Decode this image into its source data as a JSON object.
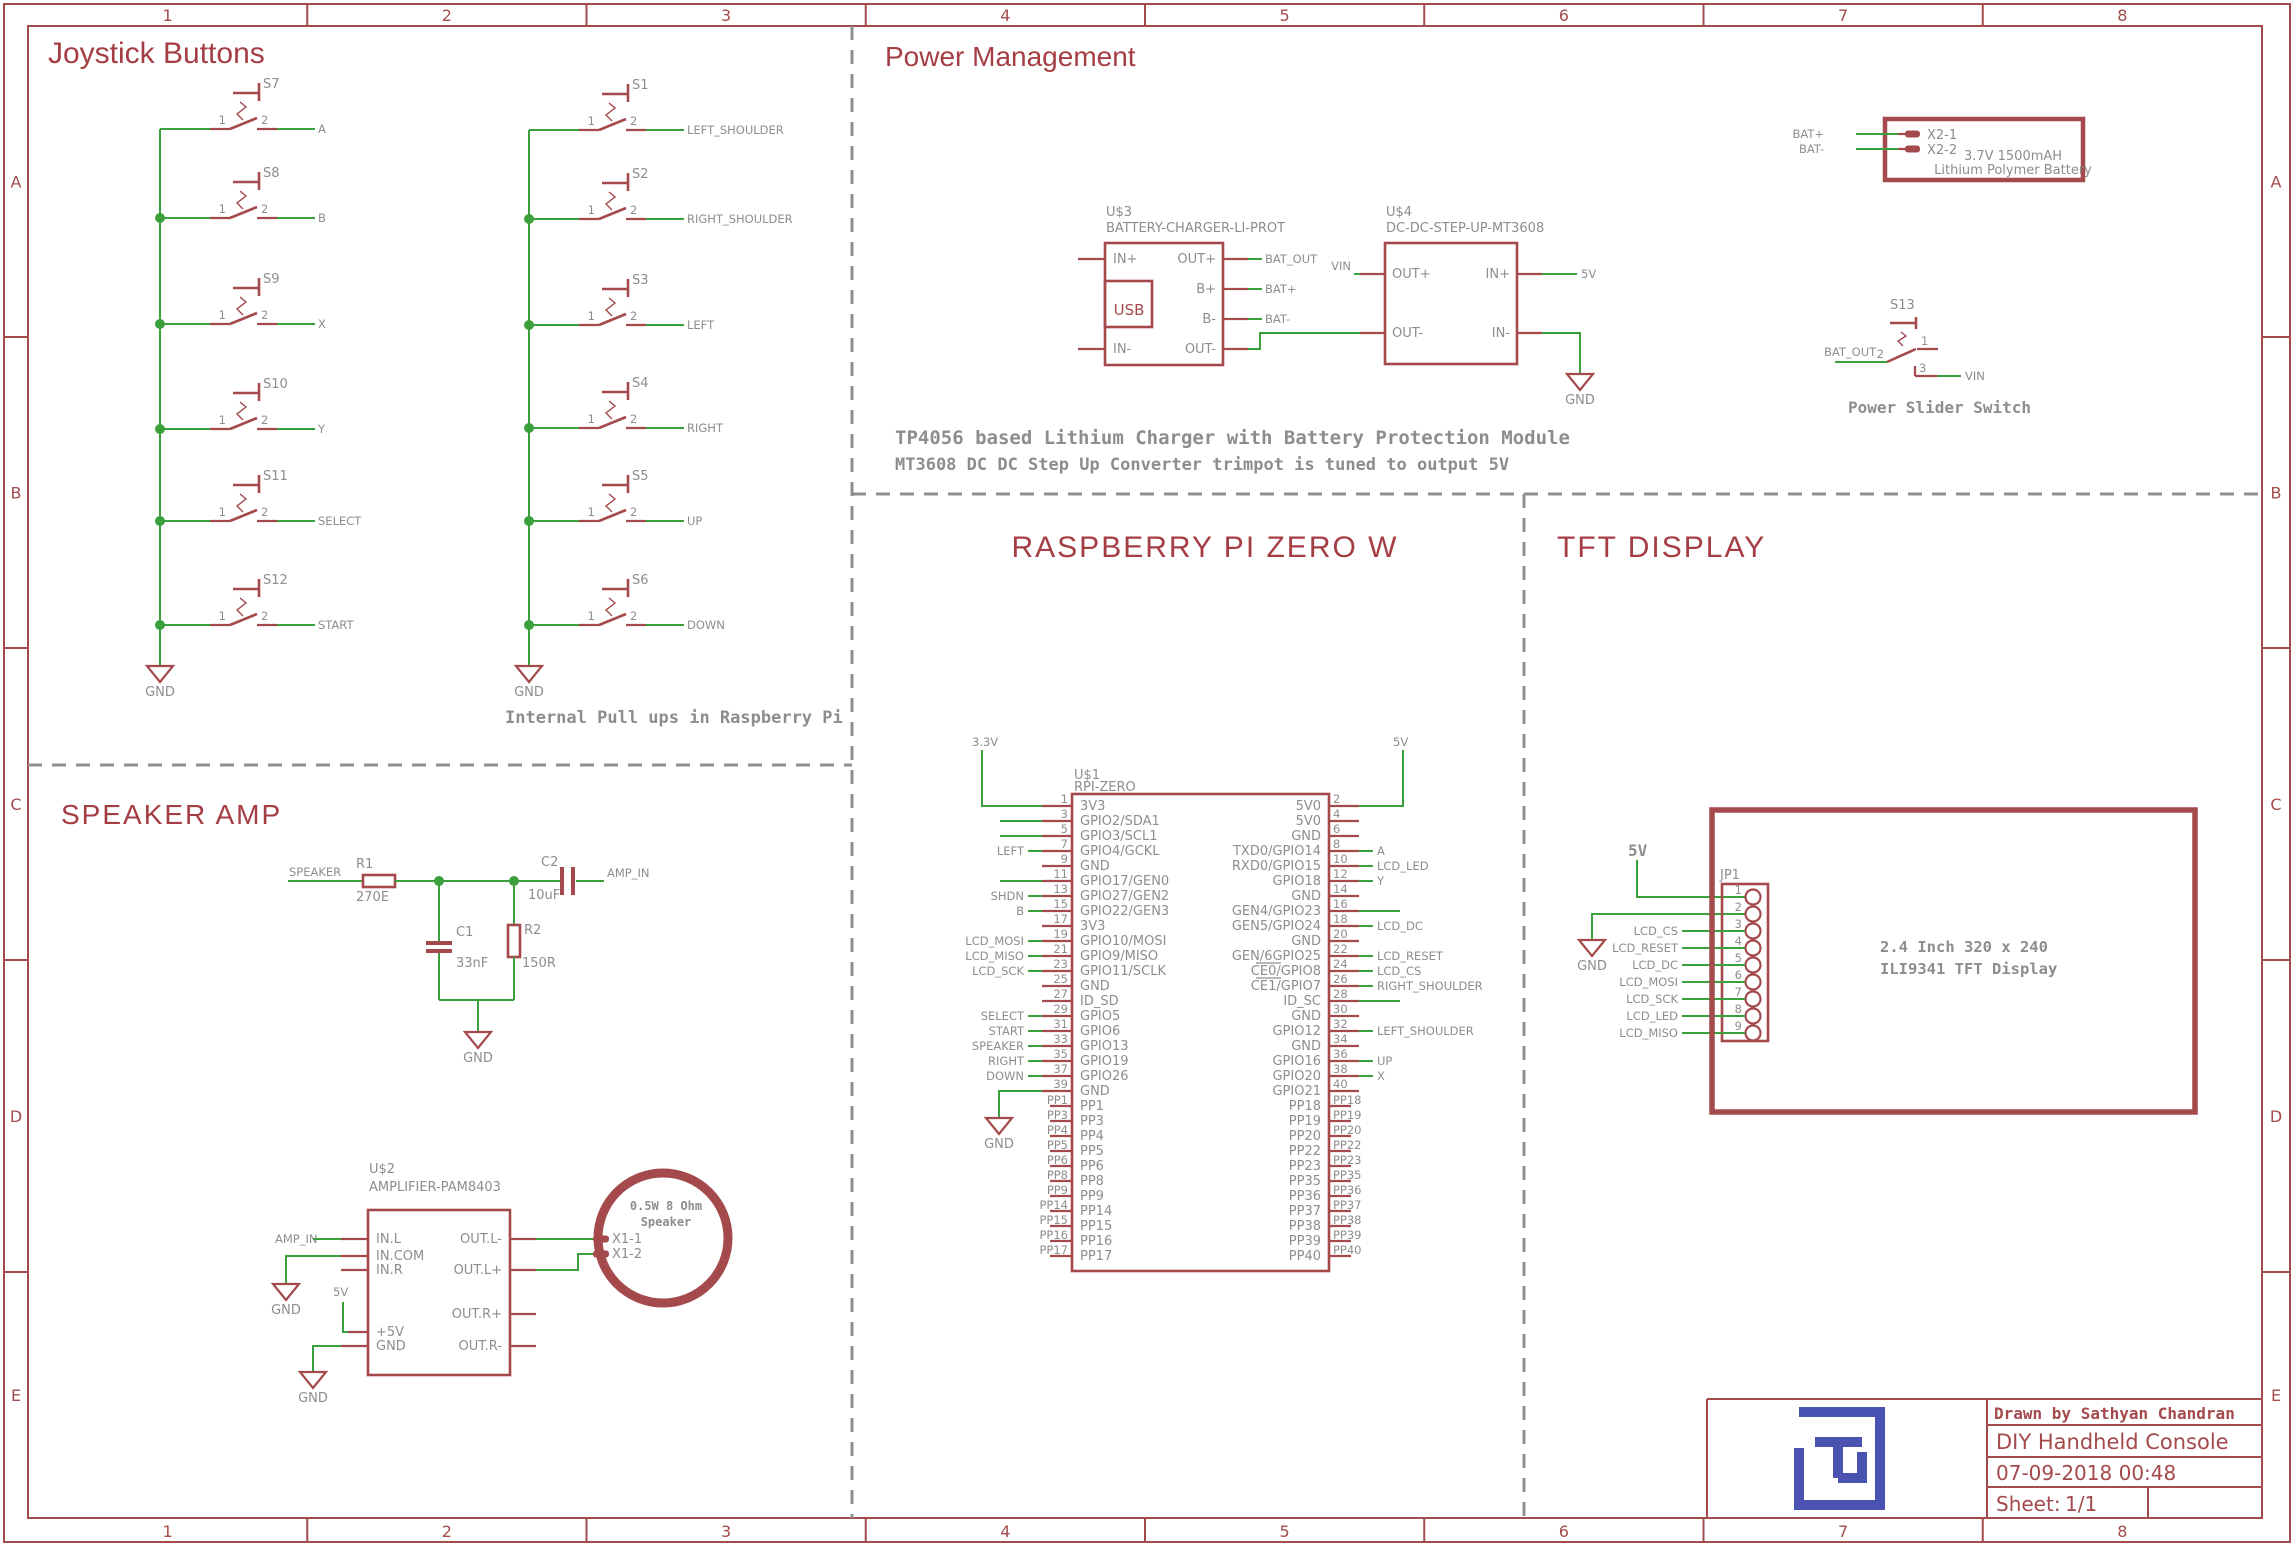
{
  "labels": {
    "gnd": "GND",
    "v5": "5V",
    "v33": "3.3V",
    "vin": "VIN"
  },
  "frame": {
    "columns": [
      "1",
      "2",
      "3",
      "4",
      "5",
      "6",
      "7",
      "8"
    ],
    "rows": [
      "A",
      "B",
      "C",
      "D",
      "E"
    ]
  },
  "sections": {
    "joystick": {
      "title": "Joystick Buttons",
      "caption": "Internal Pull ups in Raspberry Pi",
      "pin1": "1",
      "pin2": "2",
      "left_switches": [
        {
          "ref": "S7",
          "net": "A"
        },
        {
          "ref": "S8",
          "net": "B"
        },
        {
          "ref": "S9",
          "net": "X"
        },
        {
          "ref": "S10",
          "net": "Y"
        },
        {
          "ref": "S11",
          "net": "SELECT"
        },
        {
          "ref": "S12",
          "net": "START"
        }
      ],
      "right_switches": [
        {
          "ref": "S1",
          "net": "LEFT_SHOULDER"
        },
        {
          "ref": "S2",
          "net": "RIGHT_SHOULDER"
        },
        {
          "ref": "S3",
          "net": "LEFT"
        },
        {
          "ref": "S4",
          "net": "RIGHT"
        },
        {
          "ref": "S5",
          "net": "UP"
        },
        {
          "ref": "S6",
          "net": "DOWN"
        }
      ]
    },
    "power": {
      "title": "Power Management",
      "caption1": "TP4056 based Lithium Charger with Battery Protection Module",
      "caption2": "MT3608 DC DC Step Up Converter trimpot is tuned to output 5V",
      "charger": {
        "ref": "U$3",
        "value": "BATTERY-CHARGER-LI-PROT",
        "usb_label": "USB",
        "left_pins": [
          "IN+",
          "IN-"
        ],
        "right_pins": [
          "OUT+",
          "B+",
          "B-",
          "OUT-"
        ],
        "nets": [
          "BAT_OUT",
          "BAT+",
          "BAT-"
        ]
      },
      "boost": {
        "ref": "U$4",
        "value": "DC-DC-STEP-UP-MT3608",
        "left_pins": [
          "OUT+",
          "OUT-"
        ],
        "right_pins": [
          "IN+",
          "IN-"
        ]
      },
      "battery": {
        "pins": [
          "X2-1",
          "X2-2"
        ],
        "nets": [
          "BAT+",
          "BAT-"
        ],
        "line1": "3.7V 1500mAH",
        "line2": "Lithium Polymer Battery"
      },
      "slider": {
        "ref": "S13",
        "caption": "Power Slider Switch",
        "net_in": "BAT_OUT",
        "pins": [
          "1",
          "2",
          "3"
        ]
      }
    },
    "speaker_amp": {
      "title": "SPEAKER AMP",
      "net_in": "SPEAKER",
      "net_out": "AMP_IN",
      "r1": {
        "ref": "R1",
        "value": "270E"
      },
      "r2": {
        "ref": "R2",
        "value": "150R"
      },
      "c1": {
        "ref": "C1",
        "value": "33nF"
      },
      "c2": {
        "ref": "C2",
        "value": "10uF"
      },
      "amp": {
        "ref": "U$2",
        "value": "AMPLIFIER-PAM8403",
        "amp_in": "AMP_IN",
        "left_pins": [
          "IN.L",
          "IN.COM",
          "IN.R",
          "+5V",
          "GND"
        ],
        "right_pins": [
          "OUT.L-",
          "OUT.L+",
          "OUT.R+",
          "OUT.R-"
        ]
      },
      "speaker": {
        "line1": "0.5W 8 Ohm",
        "line2": "Speaker",
        "pins": [
          "X1-1",
          "X1-2"
        ]
      }
    },
    "rpi": {
      "title": "RASPBERRY PI ZERO W",
      "ref": "U$1",
      "value": "RPI-ZERO",
      "left_pins": [
        {
          "n": "1",
          "label": "3V3",
          "supply": "v33"
        },
        {
          "n": "3",
          "label": "GPIO2/SDA1",
          "stub": true
        },
        {
          "n": "5",
          "label": "GPIO3/SCL1",
          "stub": true
        },
        {
          "n": "7",
          "label": "GPIO4/GCKL",
          "net": "LEFT"
        },
        {
          "n": "9",
          "label": "GND"
        },
        {
          "n": "11",
          "label": "GPIO17/GEN0",
          "stub": true
        },
        {
          "n": "13",
          "label": "GPIO27/GEN2",
          "net": "SHDN"
        },
        {
          "n": "15",
          "label": "GPIO22/GEN3",
          "net": "B"
        },
        {
          "n": "17",
          "label": "3V3"
        },
        {
          "n": "19",
          "label": "GPIO10/MOSI",
          "net": "LCD_MOSI"
        },
        {
          "n": "21",
          "label": "GPIO9/MISO",
          "net": "LCD_MISO"
        },
        {
          "n": "23",
          "label": "GPIO11/SCLK",
          "net": "LCD_SCK"
        },
        {
          "n": "25",
          "label": "GND"
        },
        {
          "n": "27",
          "label": "ID_SD"
        },
        {
          "n": "29",
          "label": "GPIO5",
          "net": "SELECT"
        },
        {
          "n": "31",
          "label": "GPIO6",
          "net": "START"
        },
        {
          "n": "33",
          "label": "GPIO13",
          "net": "SPEAKER"
        },
        {
          "n": "35",
          "label": "GPIO19",
          "net": "RIGHT"
        },
        {
          "n": "37",
          "label": "GPIO26",
          "net": "DOWN"
        },
        {
          "n": "39",
          "label": "GND",
          "gnd": true
        }
      ],
      "right_pins": [
        {
          "n": "2",
          "label": "5V0",
          "supply": "v5"
        },
        {
          "n": "4",
          "label": "5V0"
        },
        {
          "n": "6",
          "label": "GND"
        },
        {
          "n": "8",
          "label": "TXD0/GPIO14",
          "net": "A"
        },
        {
          "n": "10",
          "label": "RXD0/GPIO15",
          "net": "LCD_LED"
        },
        {
          "n": "12",
          "label": "GPIO18",
          "net": "Y"
        },
        {
          "n": "14",
          "label": "GND"
        },
        {
          "n": "16",
          "label": "GEN4/GPIO23",
          "stub": true
        },
        {
          "n": "18",
          "label": "GEN5/GPIO24",
          "net": "LCD_DC"
        },
        {
          "n": "20",
          "label": "GND"
        },
        {
          "n": "22",
          "label": "GEN/6GPIO25",
          "net": "LCD_RESET"
        },
        {
          "n": "24",
          "label": "CE0/GPIO8",
          "net": "LCD_CS",
          "ol": true
        },
        {
          "n": "26",
          "label": "CE1/GPIO7",
          "net": "RIGHT_SHOULDER",
          "ol": true
        },
        {
          "n": "28",
          "label": "ID_SC",
          "stub": true
        },
        {
          "n": "30",
          "label": "GND"
        },
        {
          "n": "32",
          "label": "GPIO12",
          "net": "LEFT_SHOULDER"
        },
        {
          "n": "34",
          "label": "GND"
        },
        {
          "n": "36",
          "label": "GPIO16",
          "net": "UP"
        },
        {
          "n": "38",
          "label": "GPIO20",
          "net": "X"
        },
        {
          "n": "40",
          "label": "GPIO21"
        }
      ],
      "left_pp": [
        "PP1",
        "PP3",
        "PP4",
        "PP5",
        "PP6",
        "PP8",
        "PP9",
        "PP14",
        "PP15",
        "PP16",
        "PP17"
      ],
      "right_pp": [
        "PP18",
        "PP19",
        "PP20",
        "PP22",
        "PP23",
        "PP35",
        "PP36",
        "PP37",
        "PP38",
        "PP39",
        "PP40"
      ]
    },
    "tft": {
      "title": "TFT DISPLAY",
      "jp": "JP1",
      "pins": [
        "1",
        "2",
        "3",
        "4",
        "5",
        "6",
        "7",
        "8",
        "9"
      ],
      "nets": [
        "LCD_CS",
        "LCD_RESET",
        "LCD_DC",
        "LCD_MOSI",
        "LCD_SCK",
        "LCD_LED",
        "LCD_MISO"
      ],
      "display_line1": "2.4 Inch 320 x 240",
      "display_line2": "ILI9341 TFT Display"
    }
  },
  "title_block": {
    "drawn_by": "Drawn by Sathyan Chandran",
    "project": "DIY Handheld Console",
    "date": "07-09-2018 00:48",
    "sheet_label": "Sheet:",
    "sheet_value": "1/1"
  }
}
